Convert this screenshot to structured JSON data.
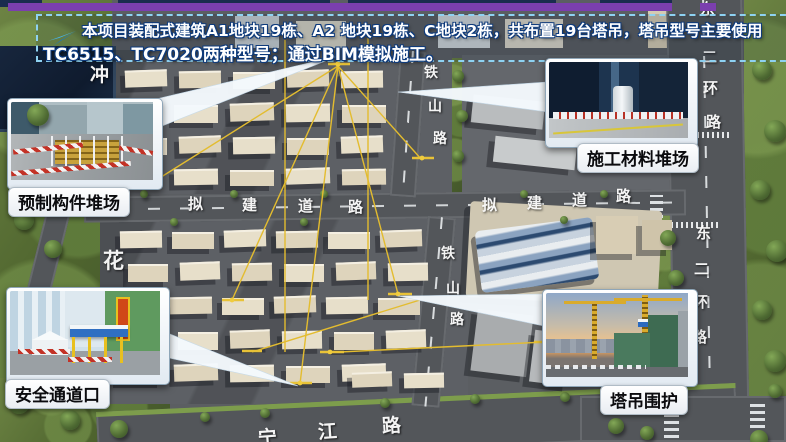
{
  "header": {
    "line1": "本项目装配式建筑A1地块19栋、A2 地块19栋、C地块2栋，共布置19台塔吊，塔吊型号主要使用",
    "line2": "TC6515、TC7020两种型号；通过BIM模拟施工。",
    "arrow_icon": "paper-plane-arrow",
    "border_color": "#8ed2f2",
    "accent_bar_color": "#7b3fae"
  },
  "callouts": {
    "precast": {
      "label": "预制构件堆场"
    },
    "material": {
      "label": "施工材料堆场"
    },
    "safety": {
      "label": "安全通道口"
    },
    "crane": {
      "label": "塔吊围护"
    }
  },
  "roads": {
    "tieshan_upper": [
      "铁",
      "山",
      "路"
    ],
    "tieshan_lower": [
      "铁",
      "山",
      "路"
    ],
    "planned_left": [
      "拟",
      "建",
      "道",
      "路"
    ],
    "planned_right": [
      "拟",
      "建",
      "道",
      "路"
    ],
    "ring_upper": [
      "东",
      "二",
      "环",
      "路"
    ],
    "ring_lower": [
      "东",
      "二",
      "环",
      "路"
    ],
    "west_top_char": "冲",
    "west_mid_char": "花",
    "bottom": [
      "宁",
      "江",
      "路"
    ]
  },
  "map_colors": {
    "road": "#53565a",
    "vegetation": "#53682f",
    "building": "#e2dac4",
    "crane_line": "#e3bc2f"
  }
}
